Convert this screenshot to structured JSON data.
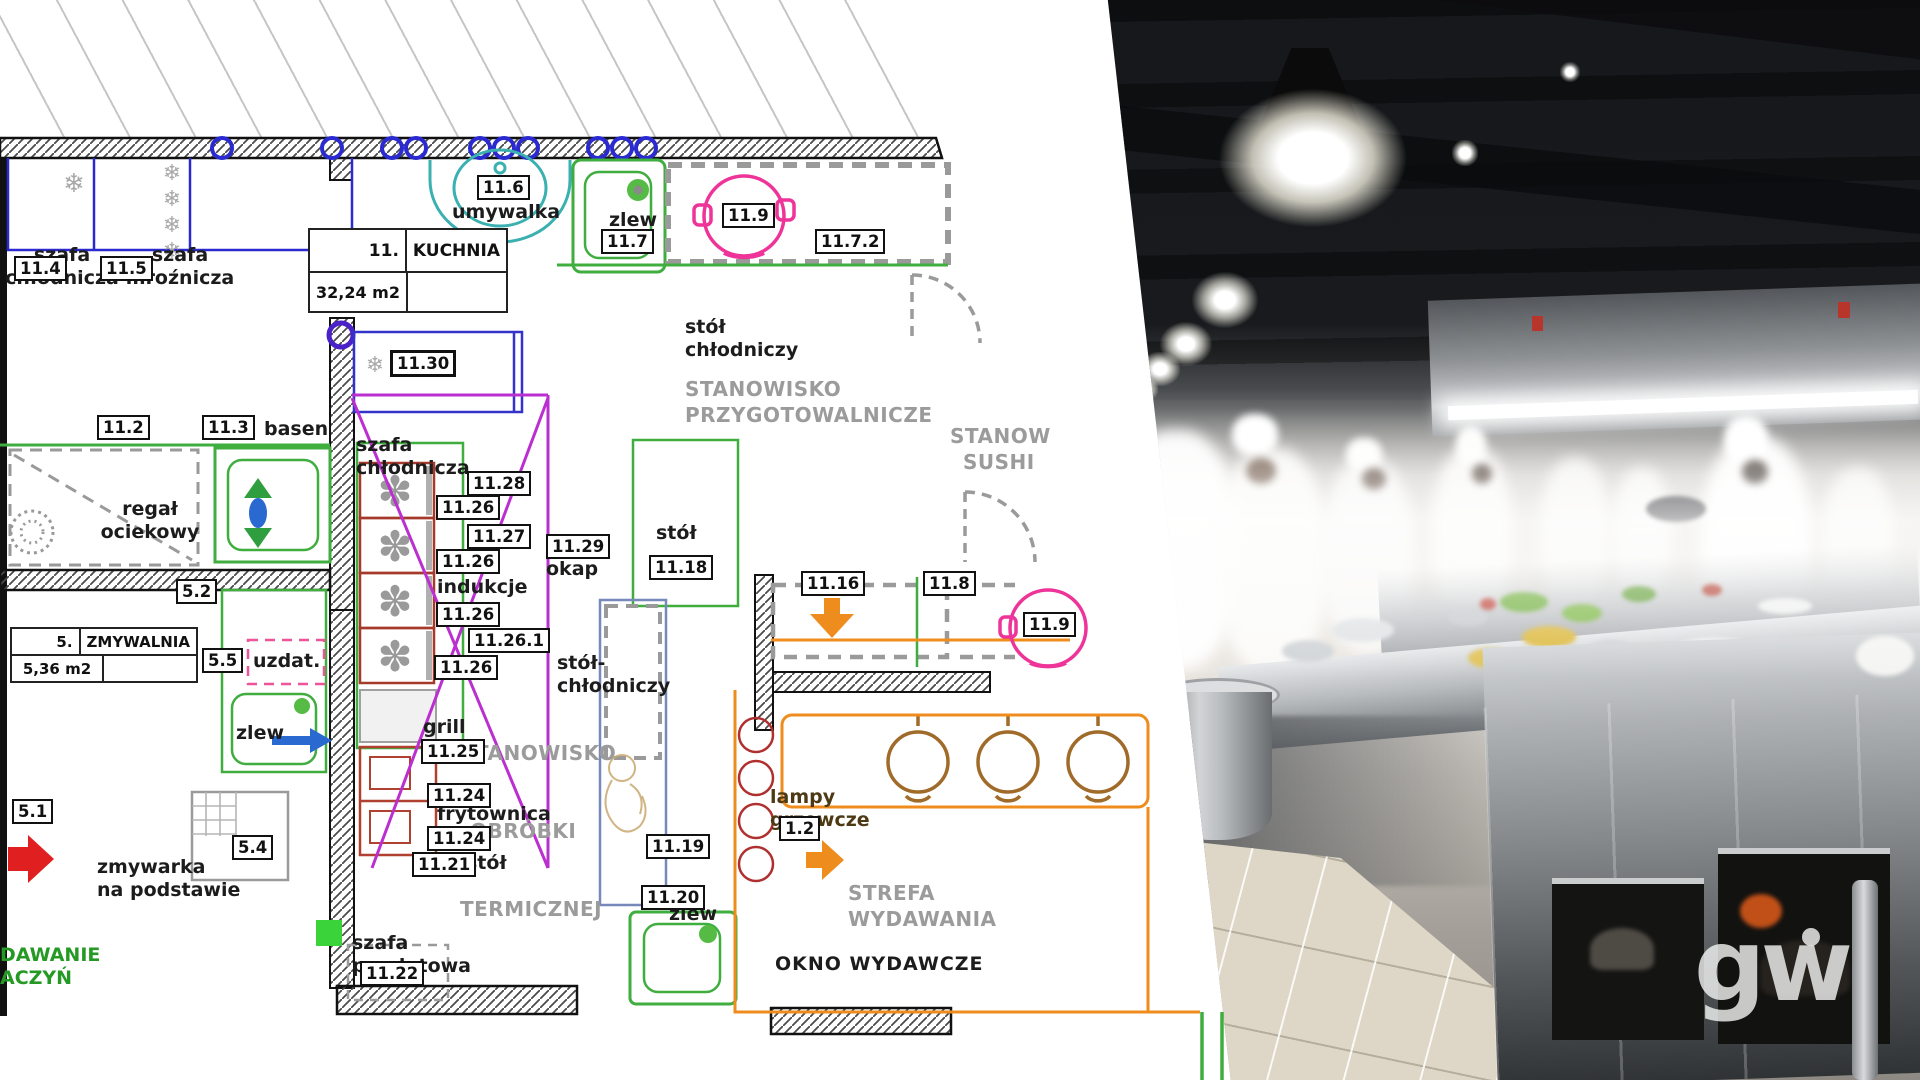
{
  "plan": {
    "rooms": {
      "kuchnia": {
        "number": "11.",
        "name": "KUCHNIA",
        "area": "32,24 m2"
      },
      "zmywalnia": {
        "number": "5.",
        "name": "ZMYWALNIA",
        "area": "5,36 m2"
      }
    },
    "tags": {
      "t11_4": "11.4",
      "t11_5": "11.5",
      "t11_6": "11.6",
      "t11_7": "11.7",
      "t11_9a": "11.9",
      "t11_7_2": "11.7.2",
      "t11_2": "11.2",
      "t11_3": "11.3",
      "t11_30": "11.30",
      "t11_28": "11.28",
      "t11_26a": "11.26",
      "t11_27": "11.27",
      "t11_26b": "11.26",
      "t11_26c": "11.26",
      "t11_26_1": "11.26.1",
      "t11_26d": "11.26",
      "t11_29": "11.29",
      "t11_18": "11.18",
      "t5_2": "5.2",
      "t5_5": "5.5",
      "t5_1": "5.1",
      "t5_4": "5.4",
      "t11_25": "11.25",
      "t11_24a": "11.24",
      "t11_24b": "11.24",
      "t11_21": "11.21",
      "t11_22": "11.22",
      "t11_19": "11.19",
      "t11_20": "11.20",
      "t11_16": "11.16",
      "t11_8": "11.8",
      "t11_9b": "11.9",
      "t1_2": "1.2"
    },
    "labels": {
      "szafa_top1_l1": "szafa",
      "szafa_top1_l2": "chłodnicza",
      "szafa_top2_l1": "szafa",
      "szafa_top2_l2": "mroźnicza",
      "umywalka": "umywalka",
      "zlew_top": "zlew",
      "stol_chl_top_l1": "stół",
      "stol_chl_top_l2": "chłodniczy",
      "stan_przyg_l1": "STANOWISKO",
      "stan_przyg_l2": "PRZYGOTOWALNICZE",
      "stanow": "STANOW",
      "sushi": "SUSHI",
      "basen": "basen",
      "regal_l1": "regał",
      "regal_l2": "ociekowy",
      "szafa_mid_l1": "szafa",
      "szafa_mid_l2": "chłodnicza",
      "indukcje": "indukcje",
      "okap": "okap",
      "stol_18": "stół",
      "stol_chl_mid_l1": "stół-",
      "stol_chl_mid_l2": "chłodniczy",
      "stan_obr_l1": "STANOWISKO",
      "stan_obr_l2": "OBRÓBKI",
      "stan_obr_l3": "TERMICZNEJ",
      "grill": "grill",
      "frytownica": "frytownica",
      "stol_21": "stół",
      "szafa_przel_l1": "szafa",
      "szafa_przel_l2": "przelotowa",
      "zmywarka_l1": "zmywarka",
      "zmywarka_l2": "na podstawie",
      "uzdat": "uzdat.",
      "zlew_zmyw": "zlew",
      "dawanie_l1": "DAWANIE",
      "dawanie_l2": "ACZYŃ",
      "lampy_l1": "lampy",
      "lampy_l2": "grzewcze",
      "strefa_l1": "STREFA",
      "strefa_l2": "WYDAWANIA",
      "okno": "OKNO WYDAWCZE",
      "zlew_bot": "zlew"
    },
    "colors": {
      "wall": "#1a1a1a",
      "green": "#3fae3f",
      "blue": "#2a2ad0",
      "teal": "#3ab0b0",
      "pink": "#ee3399",
      "magenta": "#bb2fd0",
      "burner_red": "#a63a2a",
      "orange": "#ef8c1e",
      "red_arrow": "#e02020",
      "gray_dash": "#9a9a9a",
      "brown": "#a06a28"
    }
  },
  "photo": {
    "watermark": "gw"
  }
}
